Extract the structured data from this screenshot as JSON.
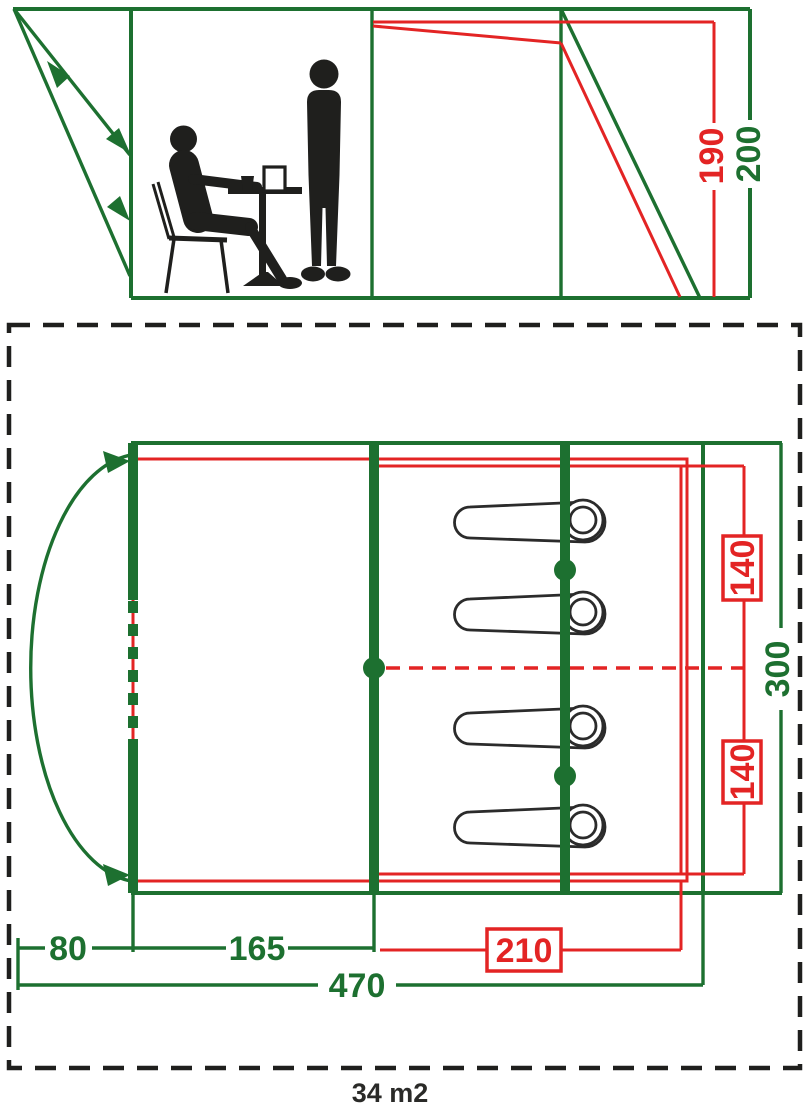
{
  "colors": {
    "green": "#1d7030",
    "red": "#e32424",
    "black": "#1f1f1d"
  },
  "elevation": {
    "inner_height_label": "190",
    "outer_height_label": "200"
  },
  "plan": {
    "bed_width_top_label": "140",
    "bed_width_bottom_label": "140",
    "total_width_label": "300",
    "porch_depth_label": "80",
    "living_depth_label": "165",
    "bedroom_depth_label": "210",
    "total_length_label": "470",
    "area_label": "34 m2",
    "sleeping_bag_count": 4
  }
}
